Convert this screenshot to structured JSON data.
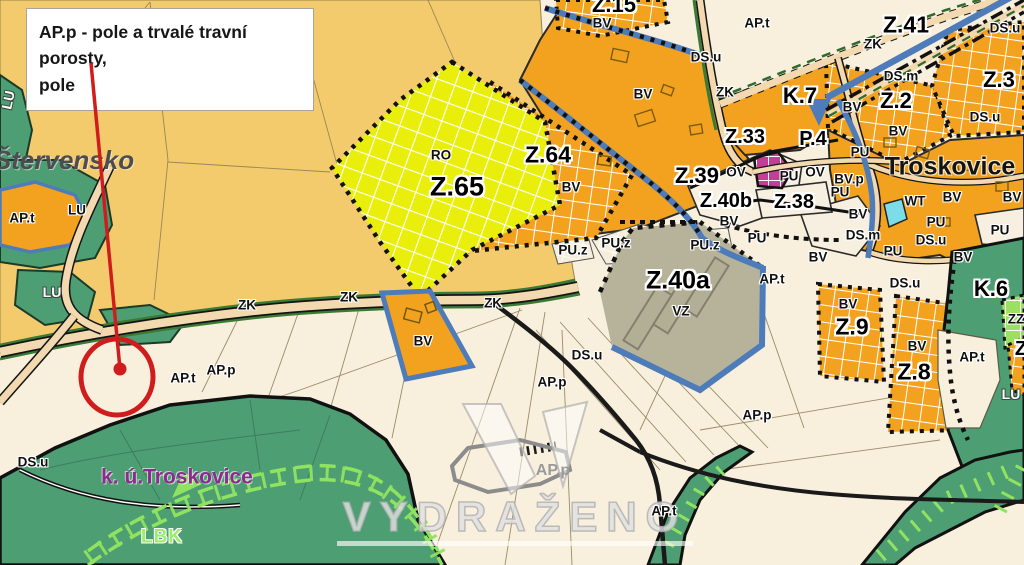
{
  "annotation": {
    "line1": "AP.p - pole a trvalé travní porosty,",
    "line2": "pole",
    "accent_color": "#cf1d1d"
  },
  "watermark": {
    "text": "VYDRAŽENO"
  },
  "colors": {
    "background_parcel": "#f8efdc",
    "field_gold": "#f3cb6c",
    "zone_yellow_ro": "#e9ee0b",
    "zone_orange_bv": "#f3a21f",
    "zone_green_lu": "#4e9e74",
    "zone_lightgreen_lbk": "#8fe360",
    "zone_khaki_vz": "#b7b39b",
    "zone_magenta_ov": "#c33f97",
    "zone_cyan_wt": "#7cdde8",
    "border_blue": "#4e7cba",
    "road_beige": "#f2d9b0",
    "road_green_strip": "#3a7a35",
    "cadastre_purple": "#8d2a8d",
    "annotation_red": "#cf1d1d"
  },
  "map": {
    "labels": [
      {
        "t": "Z.15",
        "x": 614,
        "y": 5,
        "s": "zone-big",
        "size": 22,
        "n": "zone-label-z15"
      },
      {
        "t": "BV",
        "x": 602,
        "y": 23,
        "s": "code"
      },
      {
        "t": "AP.t",
        "x": 757,
        "y": 23,
        "s": "code"
      },
      {
        "t": "DS.u",
        "x": 706,
        "y": 57,
        "s": "code"
      },
      {
        "t": "Z.41",
        "x": 906,
        "y": 25,
        "s": "zone-big",
        "size": 23,
        "n": "zone-label-z41"
      },
      {
        "t": "ZK",
        "x": 873,
        "y": 44,
        "s": "code"
      },
      {
        "t": "DS.u",
        "x": 1005,
        "y": 28,
        "s": "code"
      },
      {
        "t": "Z.3",
        "x": 999,
        "y": 80,
        "s": "zone-big",
        "size": 22,
        "n": "zone-label-z3"
      },
      {
        "t": "DS.m",
        "x": 901,
        "y": 76,
        "s": "code"
      },
      {
        "t": "Z.2",
        "x": 896,
        "y": 101,
        "s": "zone-big",
        "size": 22,
        "n": "zone-label-z2"
      },
      {
        "t": "BV",
        "x": 852,
        "y": 107,
        "s": "code"
      },
      {
        "t": "BV",
        "x": 898,
        "y": 131,
        "s": "code"
      },
      {
        "t": "DS.u",
        "x": 985,
        "y": 117,
        "s": "code"
      },
      {
        "t": "K.7",
        "x": 800,
        "y": 96,
        "s": "zone-big",
        "size": 22,
        "n": "zone-label-k7"
      },
      {
        "t": "ZK",
        "x": 725,
        "y": 92,
        "s": "code"
      },
      {
        "t": "BV",
        "x": 643,
        "y": 94,
        "s": "code"
      },
      {
        "t": "Z.33",
        "x": 745,
        "y": 137,
        "s": "zone-big",
        "n": "zone-label-z33"
      },
      {
        "t": "P.4",
        "x": 813,
        "y": 139,
        "s": "zone-big",
        "n": "zone-label-p4"
      },
      {
        "t": "PU",
        "x": 860,
        "y": 152,
        "s": "code"
      },
      {
        "t": "Troskovice",
        "x": 950,
        "y": 167,
        "s": "place",
        "n": "place-troskovice"
      },
      {
        "t": "Z.39",
        "x": 697,
        "y": 176,
        "s": "zone-big",
        "size": 22,
        "n": "zone-label-z39"
      },
      {
        "t": "OV",
        "x": 736,
        "y": 172,
        "s": "code"
      },
      {
        "t": "PU",
        "x": 789,
        "y": 176,
        "s": "code"
      },
      {
        "t": "OV",
        "x": 815,
        "y": 172,
        "s": "code"
      },
      {
        "t": "BV.p",
        "x": 849,
        "y": 179,
        "s": "code"
      },
      {
        "t": "PU",
        "x": 840,
        "y": 192,
        "s": "code"
      },
      {
        "t": "Z.40b",
        "x": 726,
        "y": 201,
        "s": "zone-big",
        "n": "zone-label-z40b"
      },
      {
        "t": "Z.38",
        "x": 794,
        "y": 202,
        "s": "zone-big",
        "n": "zone-label-z38"
      },
      {
        "t": "WT",
        "x": 915,
        "y": 201,
        "s": "code"
      },
      {
        "t": "BV",
        "x": 952,
        "y": 197,
        "s": "code"
      },
      {
        "t": "BV",
        "x": 1012,
        "y": 197,
        "s": "code"
      },
      {
        "t": "BV",
        "x": 729,
        "y": 221,
        "s": "code"
      },
      {
        "t": "BV",
        "x": 858,
        "y": 214,
        "s": "code"
      },
      {
        "t": "PU",
        "x": 936,
        "y": 222,
        "s": "code"
      },
      {
        "t": "PU",
        "x": 1000,
        "y": 230,
        "s": "code"
      },
      {
        "t": "DS.u",
        "x": 931,
        "y": 240,
        "s": "code"
      },
      {
        "t": "DS.m",
        "x": 863,
        "y": 235,
        "s": "code"
      },
      {
        "t": "PU",
        "x": 893,
        "y": 251,
        "s": "code"
      },
      {
        "t": "PU",
        "x": 757,
        "y": 238,
        "s": "code"
      },
      {
        "t": "RO",
        "x": 441,
        "y": 155,
        "s": "code"
      },
      {
        "t": "Z.65",
        "x": 457,
        "y": 187,
        "s": "zone-big",
        "size": 27,
        "n": "zone-label-z65"
      },
      {
        "t": "Z.64",
        "x": 548,
        "y": 155,
        "s": "zone-big",
        "size": 23,
        "n": "zone-label-z64"
      },
      {
        "t": "BV",
        "x": 571,
        "y": 187,
        "s": "code"
      },
      {
        "t": "PU.z",
        "x": 573,
        "y": 250,
        "s": "code"
      },
      {
        "t": "PU.z",
        "x": 616,
        "y": 243,
        "s": "code"
      },
      {
        "t": "PU.z",
        "x": 705,
        "y": 245,
        "s": "code"
      },
      {
        "t": "Z.40a",
        "x": 678,
        "y": 281,
        "s": "zone-big",
        "size": 25,
        "n": "zone-label-z40a"
      },
      {
        "t": "VZ",
        "x": 681,
        "y": 311,
        "s": "code"
      },
      {
        "t": "AP.t",
        "x": 772,
        "y": 279,
        "s": "code"
      },
      {
        "t": "BV",
        "x": 818,
        "y": 257,
        "s": "code"
      },
      {
        "t": "BV",
        "x": 963,
        "y": 257,
        "s": "code"
      },
      {
        "t": "K.6",
        "x": 991,
        "y": 289,
        "s": "zone-big",
        "size": 22,
        "n": "zone-label-k6"
      },
      {
        "t": "DS.u",
        "x": 905,
        "y": 283,
        "s": "code"
      },
      {
        "t": "Z.9",
        "x": 852,
        "y": 327,
        "s": "zone-big",
        "size": 23,
        "n": "zone-label-z9"
      },
      {
        "t": "BV",
        "x": 848,
        "y": 304,
        "s": "code"
      },
      {
        "t": "BV",
        "x": 917,
        "y": 346,
        "s": "code"
      },
      {
        "t": "Z.8",
        "x": 914,
        "y": 372,
        "s": "zone-big",
        "size": 23,
        "n": "zone-label-z8"
      },
      {
        "t": "AP.t",
        "x": 972,
        "y": 357,
        "s": "code"
      },
      {
        "t": "ZZ",
        "x": 1016,
        "y": 319,
        "s": "code"
      },
      {
        "t": "Z",
        "x": 1021,
        "y": 349,
        "s": "zone-big"
      },
      {
        "t": "LU",
        "x": 1011,
        "y": 394,
        "s": "lu-white"
      },
      {
        "t": "DS.u",
        "x": 587,
        "y": 355,
        "s": "code"
      },
      {
        "t": "AP.p",
        "x": 552,
        "y": 382,
        "s": "code"
      },
      {
        "t": "AP.p",
        "x": 553,
        "y": 471,
        "s": "gray"
      },
      {
        "t": "AP.t",
        "x": 664,
        "y": 511,
        "s": "code"
      },
      {
        "t": "AP.p",
        "x": 757,
        "y": 415,
        "s": "code"
      },
      {
        "t": "ZK",
        "x": 247,
        "y": 305,
        "s": "code"
      },
      {
        "t": "ZK",
        "x": 349,
        "y": 297,
        "s": "code"
      },
      {
        "t": "ZK",
        "x": 493,
        "y": 303,
        "s": "code"
      },
      {
        "t": "BV",
        "x": 423,
        "y": 341,
        "s": "code"
      },
      {
        "t": "AT",
        "x": 176,
        "y": 97,
        "s": "code"
      },
      {
        "t": "LU",
        "x": 8,
        "y": 100,
        "s": "lu-white",
        "rot": -78
      },
      {
        "t": "Štervensko",
        "x": 64,
        "y": 160,
        "s": "place-gray",
        "n": "place-stervensko"
      },
      {
        "t": "AP.t",
        "x": 22,
        "y": 218,
        "s": "code"
      },
      {
        "t": "LU",
        "x": 77,
        "y": 210,
        "s": "code"
      },
      {
        "t": "LU",
        "x": 52,
        "y": 292,
        "s": "lu-white"
      },
      {
        "t": "AP.t",
        "x": 183,
        "y": 378,
        "s": "code"
      },
      {
        "t": "AP.p",
        "x": 221,
        "y": 370,
        "s": "code"
      },
      {
        "t": "DS.u",
        "x": 33,
        "y": 462,
        "s": "code"
      },
      {
        "t": "k. ú.Troskovice",
        "x": 177,
        "y": 477,
        "s": "ku",
        "n": "cadastre-label"
      },
      {
        "t": "LBK",
        "x": 162,
        "y": 537,
        "s": "lbk",
        "n": "lbk-label"
      }
    ]
  }
}
